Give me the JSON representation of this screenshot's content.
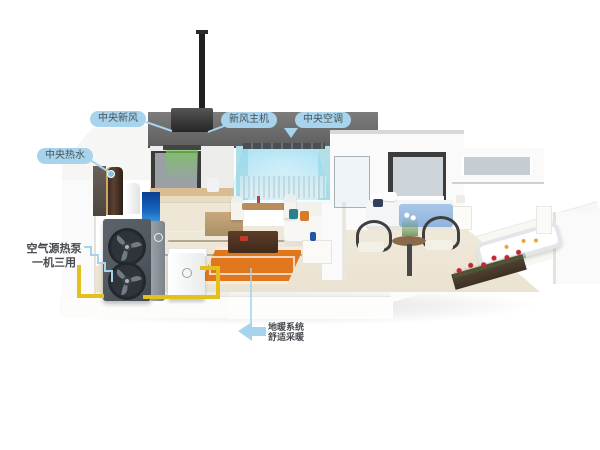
{
  "scene": {
    "description": "3D cutaway house illustration showing whole-home air-source heat pump system with central fresh air, central AC, central hot water and floor heating"
  },
  "labels": {
    "fresh_air": {
      "text": "中央新风"
    },
    "fresh_air_unit": {
      "text": "新风主机"
    },
    "central_ac": {
      "text": "中央空调"
    },
    "hot_water": {
      "text": "中央热水"
    },
    "heat_pump": {
      "line1": "空气源热泵",
      "line2": "一机三用"
    },
    "floor_heating": {
      "line1": "地暖系统",
      "line2": "舒适采暖"
    }
  },
  "colors": {
    "bubble_blue": "#a7d4ec",
    "leader_blue": "#9fd2ec",
    "label_text": "#4a5156",
    "pipe_yellow": "#e4c01d",
    "rug_orange": "#e0771c",
    "ac_air_blue": "#8cd7f0",
    "fresh_air_green": "#78c85a",
    "heatpump_body": "#50575e",
    "tank_brown": "#5d4130",
    "aquarium_blue": "#1565c0",
    "bed_blue": "#a9c7e8",
    "rose_red": "#c22535",
    "floor_cream": "#efe9da"
  }
}
